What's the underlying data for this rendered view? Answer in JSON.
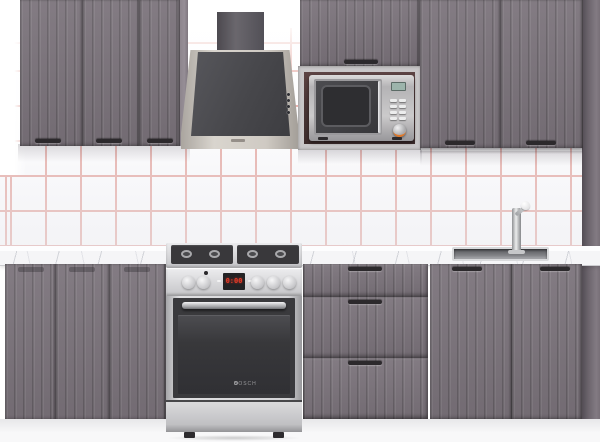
{
  "scene": {
    "description": "Straight-on product photo of a modular kitchen: fluted graphite-grey cabinet fronts, white marble worktop, white backsplash tiles with red grout grid, stainless appliances",
    "backsplash": {
      "tile_size_px": 35,
      "pattern": "square grid"
    }
  },
  "labels": {
    "oven_brand": "BOSCH",
    "stove_display_value": "0:00"
  },
  "cabinets": {
    "upper_left_doors": 3,
    "upper_middle": "lift-up door above microwave niche",
    "upper_right_doors": 2,
    "base_left_doors": 3,
    "drawer_unit_drawers": 3,
    "sink_base_doors": 2,
    "handle_style": "small black bar"
  },
  "appliances": {
    "range_hood": {
      "type": "angled wall hood with chimney duct",
      "finish": "champagne inox",
      "glass": "dark grey",
      "buttons": 4
    },
    "microwave": {
      "finish": "stainless",
      "display": "teal digital",
      "buttons": 8,
      "dial": 1
    },
    "stove": {
      "type": "freestanding gas range",
      "burners": 4,
      "knobs": 5,
      "display": "red digital clock"
    },
    "sink": {
      "type": "inset stainless basin",
      "faucet": "tall chrome mixer with white knob"
    }
  },
  "colors": {
    "wall": "#ffffff",
    "grout": "#e7b0aa",
    "cabinet": "#7b737b",
    "handle": "#2c292c",
    "counter": "#f5f5f7",
    "stainless": "#d4d4d6",
    "dark-glass": "#3b3b3e",
    "hood-frame": "#c9c4bc",
    "hood-glass": "#4a4a4e",
    "duct": "#57545a",
    "niche": "#4b3737",
    "plinth": "#f0f0f2",
    "display-red": "#e03a28",
    "display-teal": "#9cb4ab",
    "accent-orange": "#e07828"
  }
}
